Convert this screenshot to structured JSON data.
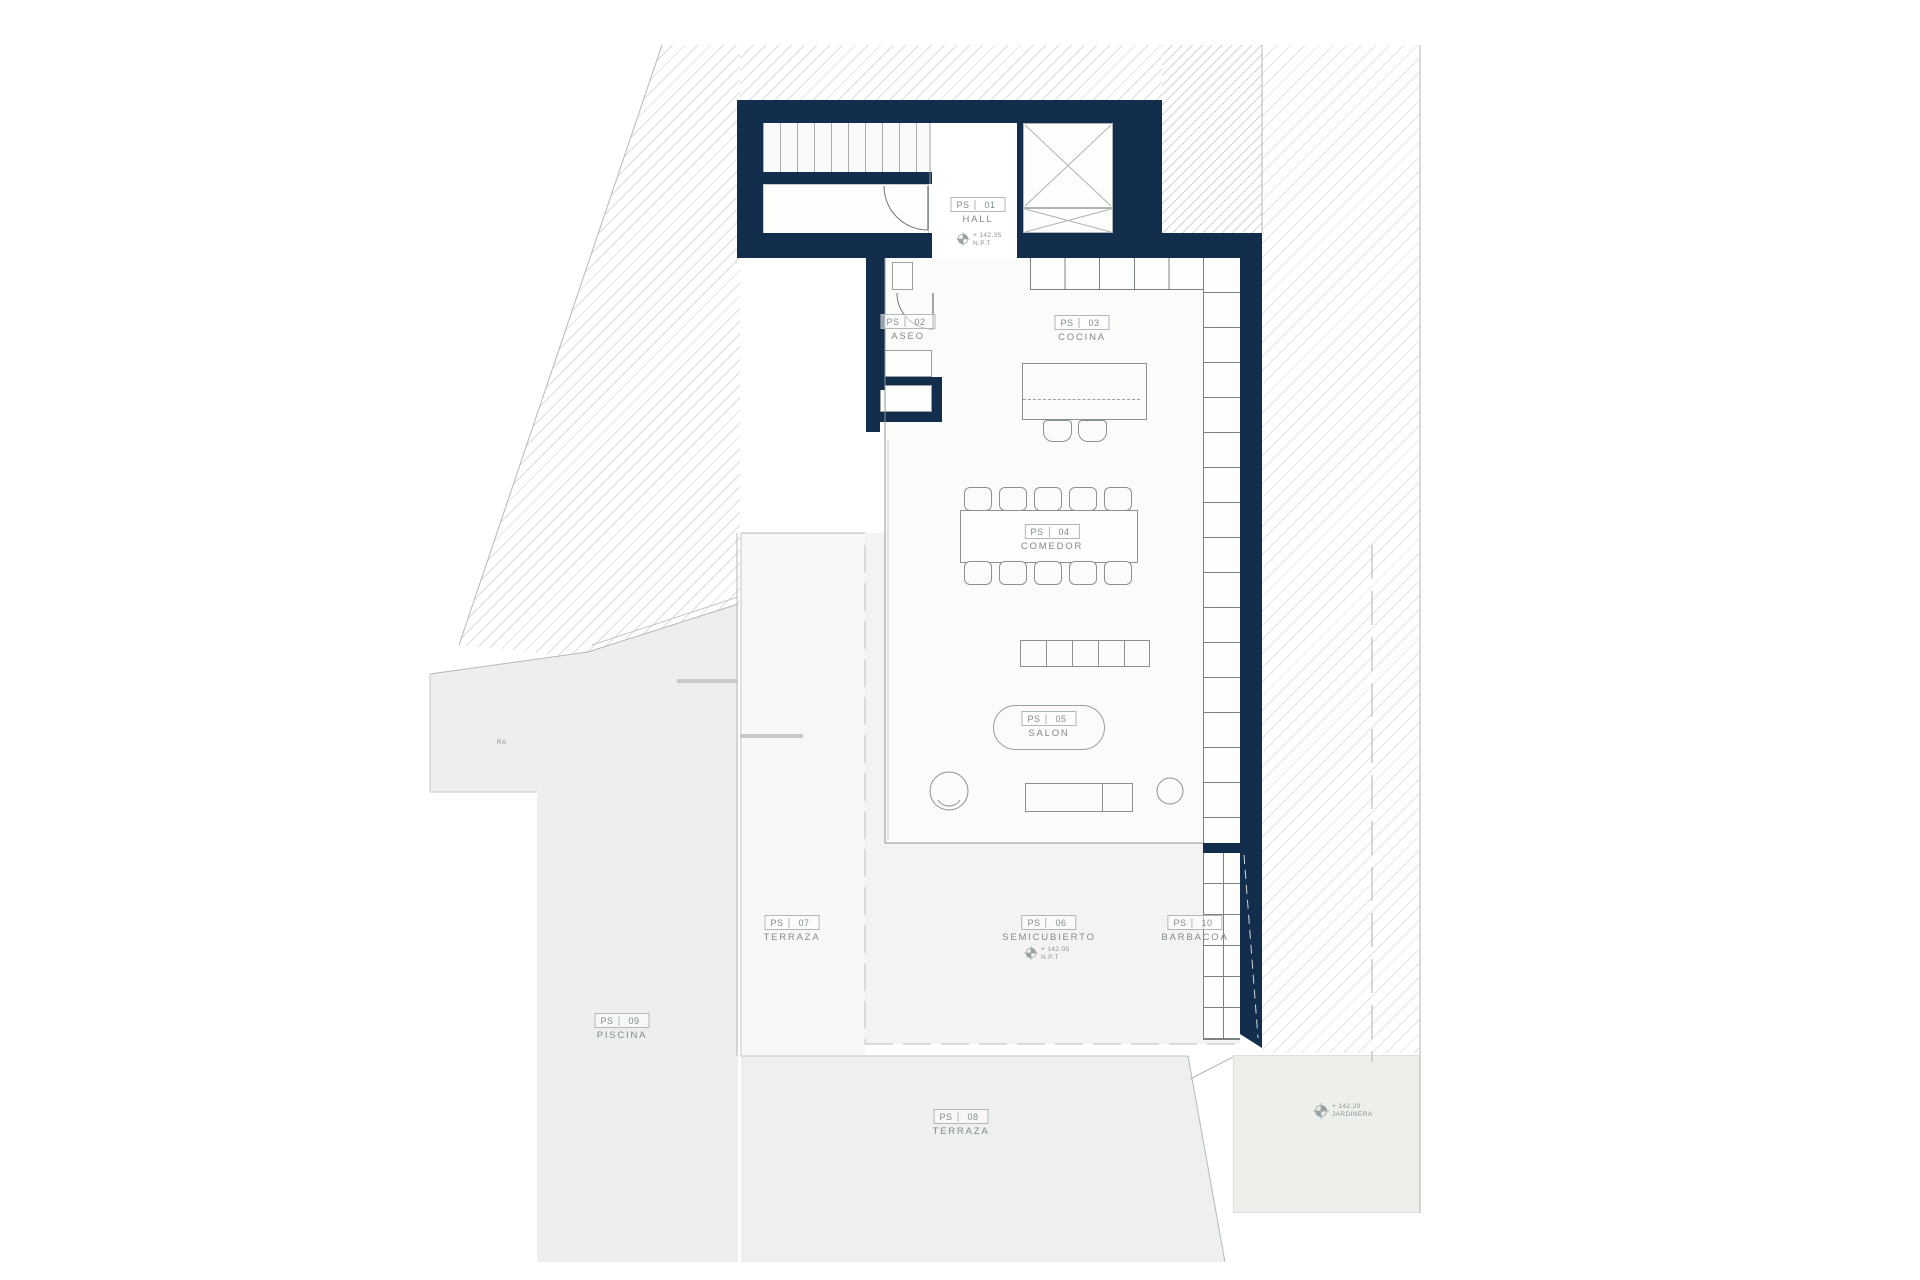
{
  "plan": {
    "rooms": [
      {
        "code": "PS",
        "num": "01",
        "name": "HALL"
      },
      {
        "code": "PS",
        "num": "02",
        "name": "ASEO"
      },
      {
        "code": "PS",
        "num": "03",
        "name": "COCINA"
      },
      {
        "code": "PS",
        "num": "04",
        "name": "COMEDOR"
      },
      {
        "code": "PS",
        "num": "05",
        "name": "SALON"
      },
      {
        "code": "PS",
        "num": "06",
        "name": "SEMICUBIERTO"
      },
      {
        "code": "PS",
        "num": "07",
        "name": "TERRAZA"
      },
      {
        "code": "PS",
        "num": "08",
        "name": "TERRAZA"
      },
      {
        "code": "PS",
        "num": "09",
        "name": "PISCINA"
      },
      {
        "code": "PS",
        "num": "10",
        "name": "BARBACOA"
      }
    ],
    "levels": {
      "hall": {
        "value": "+ 142.35",
        "datum": "N.P.T"
      },
      "semicubierto": {
        "value": "+ 142.05",
        "datum": "N.P.T"
      },
      "jardinera": {
        "value": "+ 142.20",
        "label": "JARDINERA"
      }
    },
    "fragments": {
      "left_edge": "RA"
    },
    "colors": {
      "wall_navy": "#132d4d",
      "line_gray": "#8f9595",
      "hatch_gray": "#dcdcdc",
      "pale_green": "#ecefeb"
    }
  }
}
